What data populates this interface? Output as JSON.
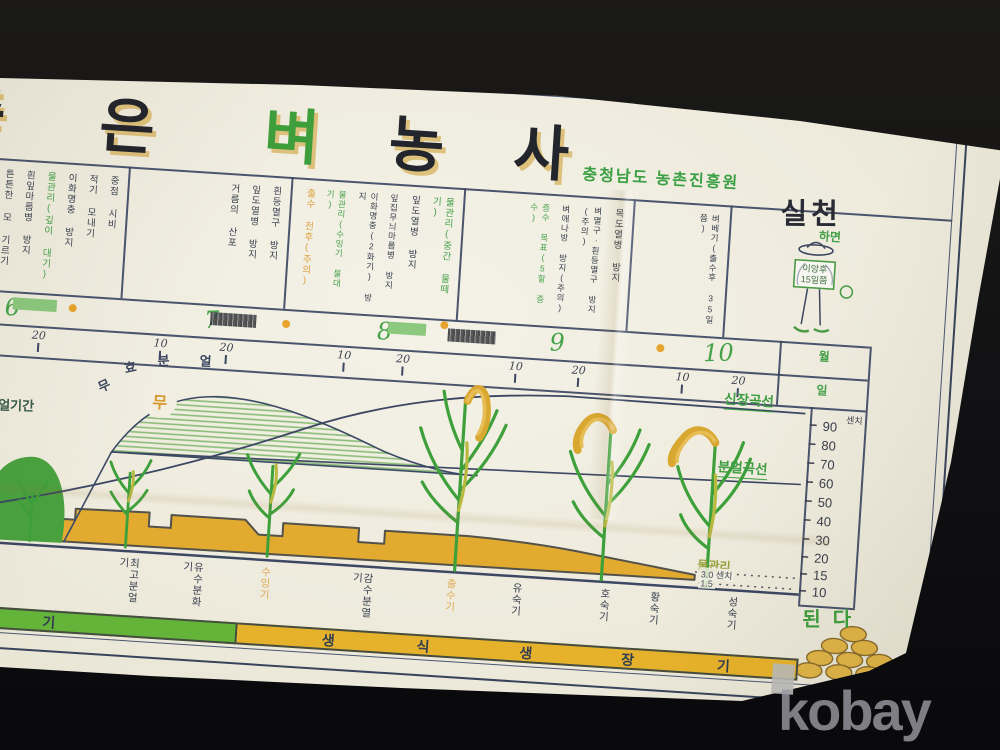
{
  "watermark": "kobay",
  "poster": {
    "title": {
      "text": "좋은 벼농사",
      "chars": [
        {
          "ch": "좋"
        },
        {
          "ch": "은"
        },
        {
          "ch": "벼"
        },
        {
          "ch": "농"
        },
        {
          "ch": "사"
        }
      ]
    },
    "issuer": "충청남도 농촌진흥원",
    "practice": {
      "headline": "실천",
      "suffix": "하면",
      "result": "된다",
      "farmer_sign": [
        "이앙후",
        "15일쯤"
      ]
    },
    "calendar": {
      "month_row_label": "월",
      "day_row_label": "일",
      "months": [
        {
          "num": "6",
          "day_ticks": [
            "20"
          ],
          "tasks": [
            {
              "text": "중점 시비",
              "color": "ink"
            },
            {
              "text": "적기 모내기",
              "color": "ink"
            },
            {
              "text": "이화명충 방지",
              "color": "ink"
            },
            {
              "text": "물관리(깊이 대기)",
              "color": "green"
            },
            {
              "text": "흰잎마름병 방지",
              "color": "ink"
            },
            {
              "text": "튼튼한 모 기르기",
              "color": "ink"
            }
          ]
        },
        {
          "num": "7",
          "day_ticks": [
            "10",
            "20"
          ],
          "tasks": [
            {
              "text": "흰등멸구 방지",
              "color": "ink"
            },
            {
              "text": "잎도열병 방지",
              "color": "ink"
            },
            {
              "text": "거름의 산포",
              "color": "ink"
            }
          ]
        },
        {
          "num": "8",
          "day_ticks": [
            "10",
            "20"
          ],
          "tasks": [
            {
              "text": "물관리(중간 물떼기)",
              "color": "green"
            },
            {
              "text": "잎도열병 방지",
              "color": "ink"
            },
            {
              "text": "잎집무늬마름병 방지",
              "color": "ink"
            },
            {
              "text": "이화명충(2화기) 방지",
              "color": "ink"
            },
            {
              "text": "물관리(수잉기 물대기)",
              "color": "green"
            },
            {
              "text": "출수 전후(주의)",
              "color": "orange"
            }
          ]
        },
        {
          "num": "9",
          "day_ticks": [
            "10",
            "20"
          ],
          "tasks": [
            {
              "text": "목도열병 방지",
              "color": "ink"
            },
            {
              "text": "벼멸구·흰등멸구 방지(주의)",
              "color": "ink"
            },
            {
              "text": "벼애나방 방지(주의)",
              "color": "ink"
            },
            {
              "text": "증수 목표(5할 증수)",
              "color": "green"
            }
          ]
        },
        {
          "num": "10",
          "day_ticks": [
            "10",
            "20"
          ],
          "tasks": [
            {
              "text": "벼베기(출수후 35일쯤)",
              "color": "ink"
            }
          ]
        }
      ]
    },
    "chart": {
      "unit": "센치",
      "axis_ticks": [
        "90",
        "80",
        "70",
        "60",
        "50",
        "40",
        "30",
        "20",
        "15",
        "10"
      ],
      "labels": {
        "growth_curve": "신장곡선",
        "tiller_curve": "분얼곡선",
        "ineffective_mark": "무",
        "effective_mark": "유",
        "effective_period": "유효분얼기간",
        "effective_days": "~20일",
        "water": "물관리",
        "water_depth1": "3.0 센치",
        "water_depth2": "1.5"
      },
      "ineffective_chars": [
        "무",
        "효",
        "분",
        "얼"
      ],
      "stages": [
        {
          "text": "분얼개시기",
          "color": "ink"
        },
        {
          "text": "최고분얼기",
          "color": "ink"
        },
        {
          "text": "유수분화기",
          "color": "ink"
        },
        {
          "text": "수잉기",
          "color": "orange"
        },
        {
          "text": "감수분열기",
          "color": "ink"
        },
        {
          "text": "출수기",
          "color": "orange"
        },
        {
          "text": "유숙기",
          "color": "ink"
        },
        {
          "text": "호숙기",
          "color": "ink"
        },
        {
          "text": "황숙기",
          "color": "ink"
        },
        {
          "text": "성숙기",
          "color": "ink"
        }
      ]
    },
    "banner": {
      "green_chars": [
        "기"
      ],
      "yellow_chars": [
        "생",
        "식",
        "생",
        "장",
        "기"
      ]
    }
  },
  "chart_data": {
    "type": "line",
    "title": "좋은 벼농사 — 벼 생육 곡선 (충청남도 농촌진흥원)",
    "xlabel": "월(6~10월)·일(10,20)",
    "ylabel": "센치",
    "ylim": [
      10,
      90
    ],
    "x": [
      "6.20",
      "7.1",
      "7.10",
      "7.20",
      "8.1",
      "8.10",
      "8.20",
      "9.1",
      "9.10",
      "9.20",
      "10.1",
      "10.10"
    ],
    "series": [
      {
        "name": "신장곡선",
        "values": [
          5,
          15,
          28,
          42,
          55,
          68,
          78,
          84,
          88,
          90,
          90,
          90
        ]
      },
      {
        "name": "분얼곡선",
        "values": [
          10,
          35,
          70,
          85,
          75,
          66,
          62,
          60,
          60,
          60,
          60,
          60
        ]
      }
    ],
    "annotations": [
      "무효분얼",
      "유효분얼기간 ~20일",
      "물관리 3.0 센치 / 1.5",
      "실천하면 된다"
    ],
    "stages": [
      "분얼개시기",
      "최고분얼기",
      "유수분화기",
      "수잉기",
      "감수분열기",
      "출수기",
      "유숙기",
      "호숙기",
      "황숙기",
      "성숙기"
    ],
    "phases": [
      "영양생장기",
      "생식생장기"
    ],
    "legend_position": "right-on-curve",
    "grid": false
  }
}
